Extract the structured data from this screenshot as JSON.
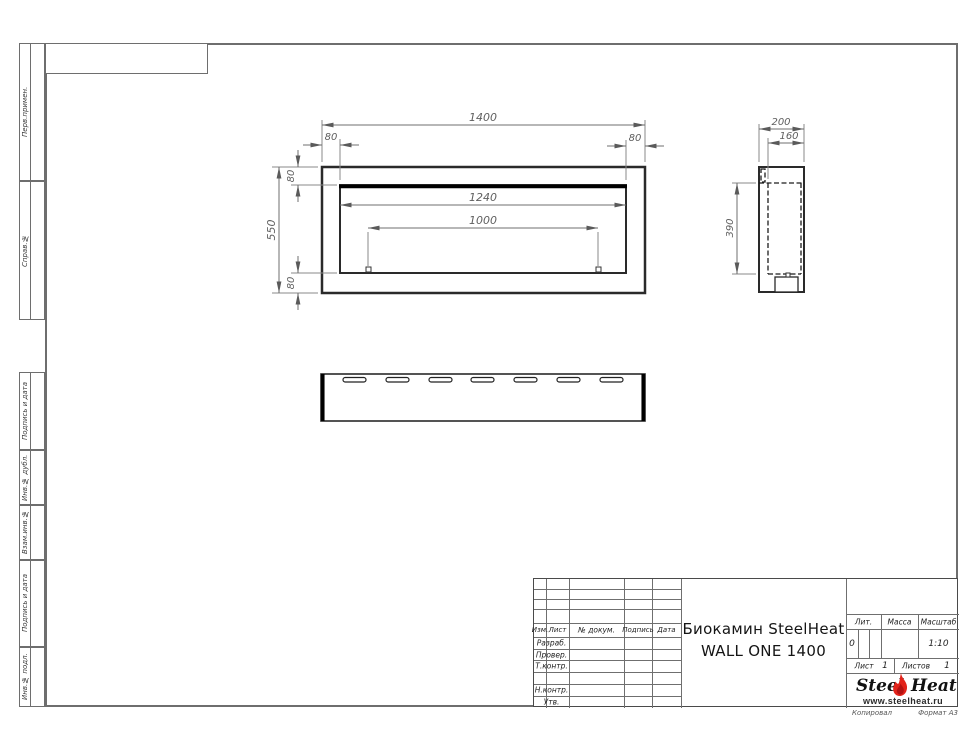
{
  "document": {
    "type_note": "engineering drawing sheet",
    "product_line1": "Биокамин SteelHeat",
    "product_line2": "WALL ONE 1400"
  },
  "margin_labels": [
    "Перв.примен.",
    "Справ.№",
    "Подпись и дата",
    "Инв.№ дубл.",
    "Взам.инв.№",
    "Подпись и дата",
    "Инв.№ подл."
  ],
  "dims": {
    "front_width": "1400",
    "offset": "80",
    "front_height": "550",
    "opening_width": "1240",
    "burner_width": "1000",
    "depth": "200",
    "inner_depth": "160",
    "opening_height": "390"
  },
  "title_block": {
    "columns": {
      "izm": "Изм.",
      "list": "Лист",
      "doc": "№ докум.",
      "podpis": "Подпись",
      "data": "Дата"
    },
    "rows": {
      "razrab": "Разраб.",
      "prover": "Провер.",
      "tkontr": "Т.контр.",
      "nkontr": "Н.контр.",
      "utv": "Утв."
    },
    "lit_label": "Лит.",
    "massa_label": "Масса",
    "masshtab_label": "Масштаб",
    "lit_value": "0",
    "masshtab_value": "1:10",
    "list_label": "Лист",
    "list_value": "1",
    "listov_label": "Листов",
    "listov_value": "1"
  },
  "logo": {
    "steel": "Steel",
    "heat": "Heat",
    "site": "www.steelheat.ru"
  },
  "footer": {
    "copied": "Копировал",
    "format": "Формат А3"
  },
  "colors": {
    "flame_red": "#e2231a",
    "contour": "#2a2a2a",
    "thin_line": "#7a7a7a"
  }
}
